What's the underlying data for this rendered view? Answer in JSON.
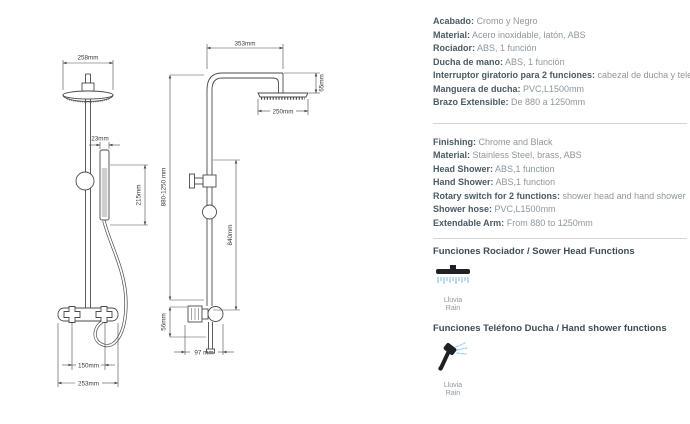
{
  "drawings": {
    "front": {
      "head_width": "258mm",
      "hand_shower_width": "23mm",
      "hand_shower_height": "215mm",
      "inlet_spacing": "150mm",
      "bottom_width": "253mm"
    },
    "side": {
      "arm_length": "353mm",
      "head_drop": "65mm",
      "head_diameter": "250mm",
      "rail_length": "840mm",
      "total_height": "880-1250 mm",
      "valve_drop": "56mm",
      "bottom_depth": "97 mm"
    }
  },
  "specs_es": [
    {
      "label": "Acabado:",
      "value": "Cromo y Negro"
    },
    {
      "label": "Material:",
      "value": "Acero inoxidable, latón, ABS"
    },
    {
      "label": "Rociador:",
      "value": "ABS, 1 función"
    },
    {
      "label": "Ducha de mano:",
      "value": "ABS, 1 función"
    },
    {
      "label": "Interruptor giratorio para 2 funciones:",
      "value": "cabezal de ducha y teleducha"
    },
    {
      "label": "Manguera de ducha:",
      "value": "PVC,L1500mm"
    },
    {
      "label": "Brazo Extensible:",
      "value": "De 880 a 1250mm"
    }
  ],
  "specs_en": [
    {
      "label": "Finishing:",
      "value": "Chrome and Black"
    },
    {
      "label": "Material:",
      "value": "Stainless Steel, brass, ABS"
    },
    {
      "label": "Head Shower:",
      "value": "ABS,1 function"
    },
    {
      "label": "Hand Shower:",
      "value": "ABS,1 function"
    },
    {
      "label": "Rotary switch for 2 functions:",
      "value": "shower head and hand shower"
    },
    {
      "label": "Shower hose:",
      "value": "PVC,L1500mm"
    },
    {
      "label": "Extendable Arm:",
      "value": "From 880 to 1250mm"
    }
  ],
  "functions": {
    "shower_head": {
      "title": "Funciones Rociador /  Sower Head Functions",
      "caption_top": "Lluvia",
      "caption_bottom": "Rain"
    },
    "hand_shower": {
      "title": "Funciones Teléfono Ducha / Hand shower functions",
      "caption_top": "Lluvia",
      "caption_bottom": "Rain"
    }
  },
  "colors": {
    "label": "#4a5a64",
    "value": "#8d979e",
    "heading": "#3d4d57",
    "caption": "#8d979e",
    "rain_blue": "#9fd0ee",
    "line": "#4a4a4a",
    "dim_text": "#3a3a3a",
    "divider": "#d5d5d5",
    "icon_dark": "#1e2226"
  }
}
